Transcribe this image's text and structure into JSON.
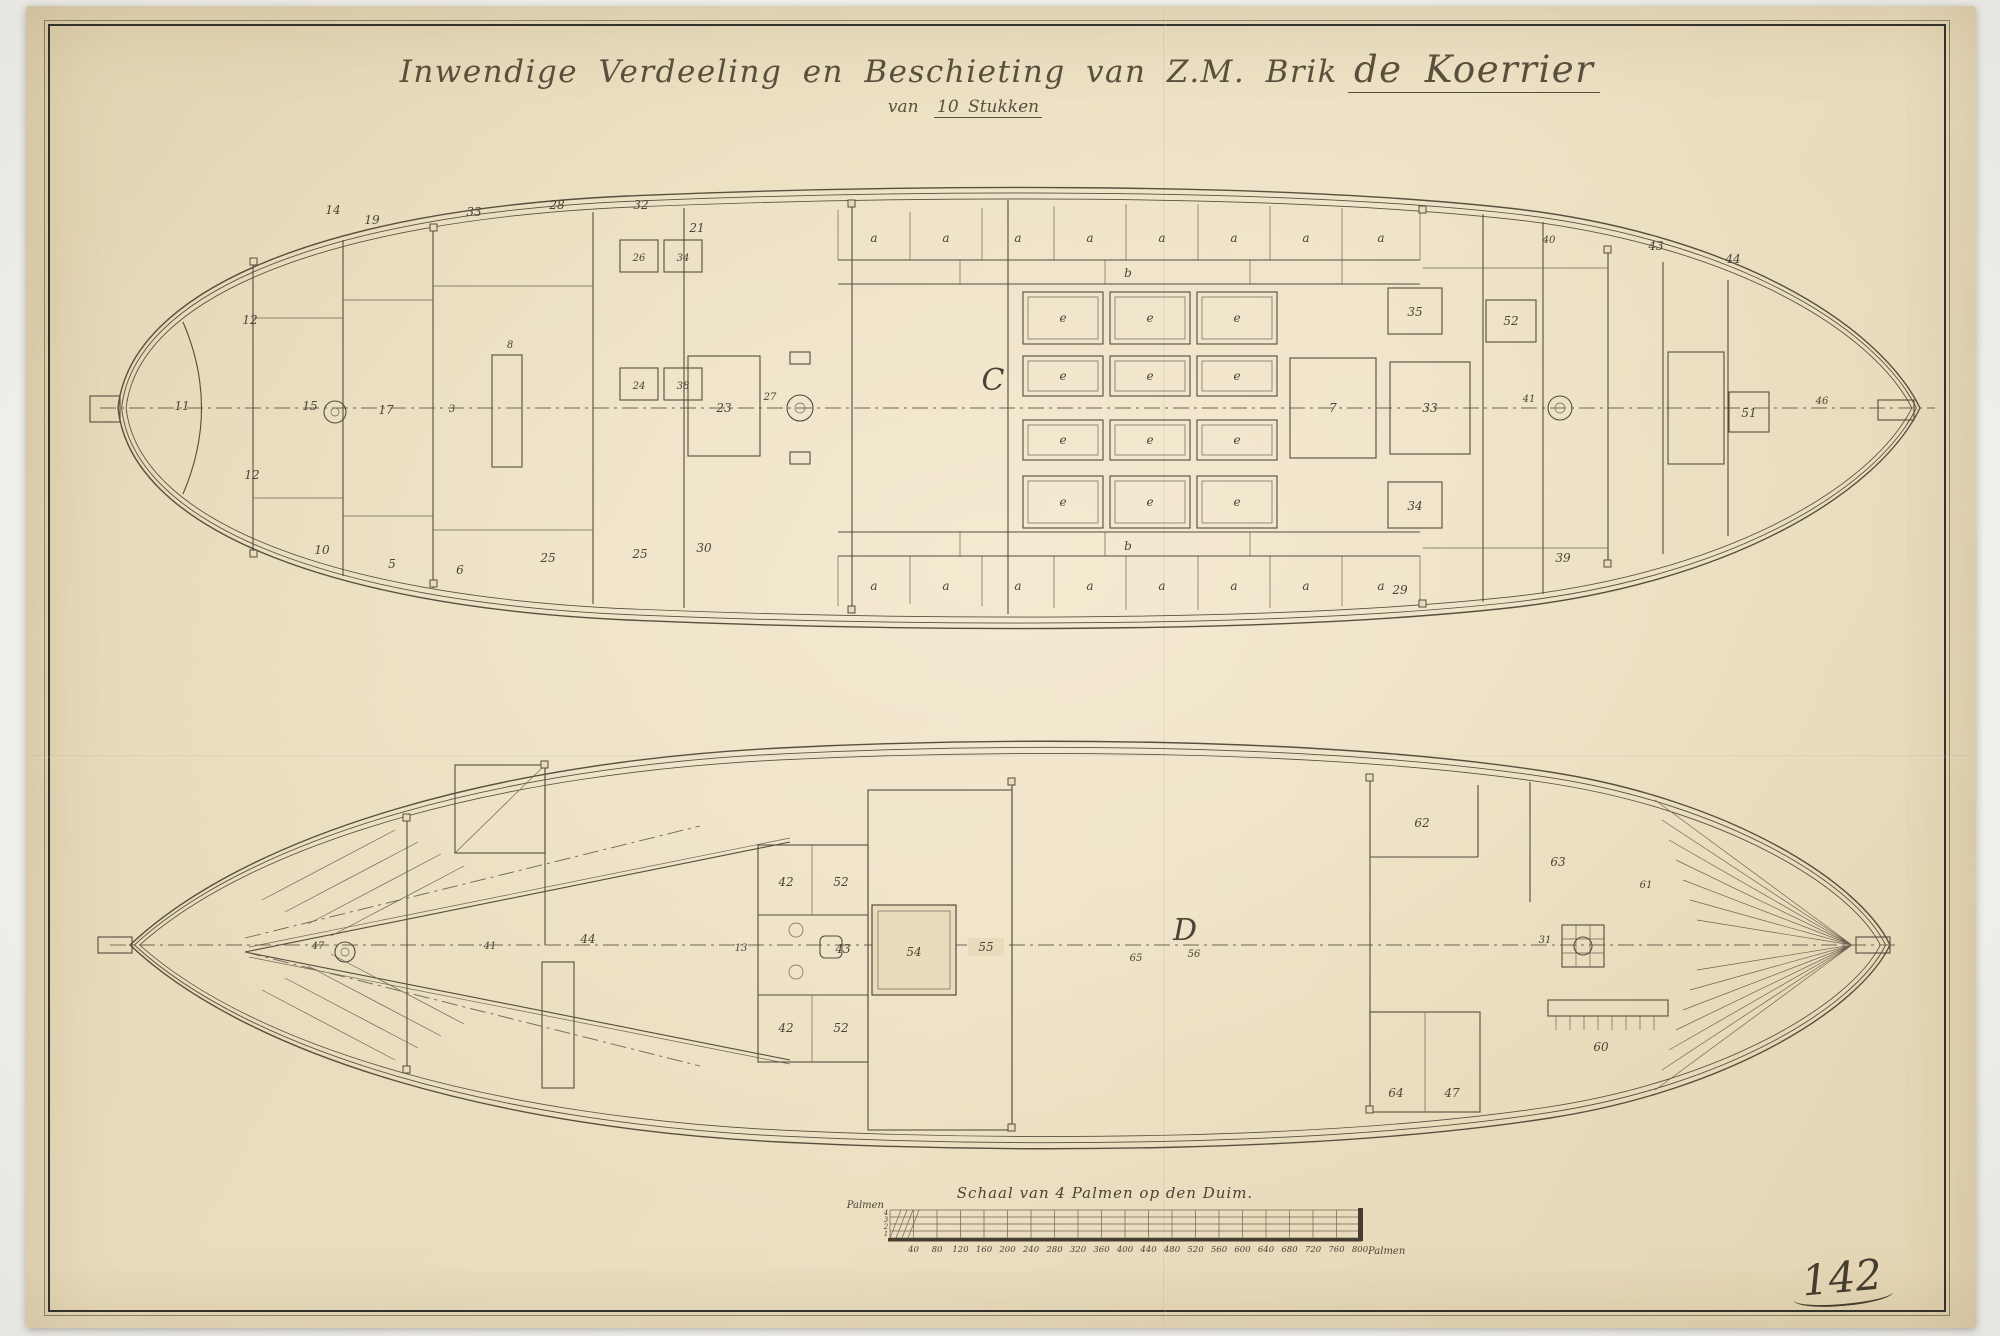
{
  "document": {
    "title_line1": "Inwendige Verdeeling en Beschieting van Z.M. Brik",
    "ship_name": "de Koerrier",
    "subtitle_prefix": "van",
    "subtitle_value": "10 Stukken",
    "sheet_number": "142"
  },
  "colors": {
    "paper": "#e9dcbd",
    "ink": "#4b4336",
    "frame": "#35322a",
    "backdrop": "#f1f0ec"
  },
  "plans": {
    "top": {
      "deck_letter": "C",
      "labels": [
        {
          "t": "a",
          "x": 874,
          "y": 242
        },
        {
          "t": "a",
          "x": 946,
          "y": 242
        },
        {
          "t": "a",
          "x": 1018,
          "y": 242
        },
        {
          "t": "a",
          "x": 1090,
          "y": 242
        },
        {
          "t": "a",
          "x": 1162,
          "y": 242
        },
        {
          "t": "a",
          "x": 1234,
          "y": 242
        },
        {
          "t": "a",
          "x": 1306,
          "y": 242
        },
        {
          "t": "a",
          "x": 1381,
          "y": 242
        },
        {
          "t": "b",
          "x": 1128,
          "y": 277
        },
        {
          "t": "a",
          "x": 874,
          "y": 590
        },
        {
          "t": "a",
          "x": 946,
          "y": 590
        },
        {
          "t": "a",
          "x": 1018,
          "y": 590
        },
        {
          "t": "a",
          "x": 1090,
          "y": 590
        },
        {
          "t": "a",
          "x": 1162,
          "y": 590
        },
        {
          "t": "a",
          "x": 1234,
          "y": 590
        },
        {
          "t": "a",
          "x": 1306,
          "y": 590
        },
        {
          "t": "a",
          "x": 1381,
          "y": 590
        },
        {
          "t": "b",
          "x": 1128,
          "y": 550
        },
        {
          "t": "e",
          "x": 1063,
          "y": 322
        },
        {
          "t": "e",
          "x": 1150,
          "y": 322
        },
        {
          "t": "e",
          "x": 1237,
          "y": 322
        },
        {
          "t": "e",
          "x": 1063,
          "y": 380
        },
        {
          "t": "e",
          "x": 1150,
          "y": 380
        },
        {
          "t": "e",
          "x": 1237,
          "y": 380
        },
        {
          "t": "e",
          "x": 1063,
          "y": 444
        },
        {
          "t": "e",
          "x": 1150,
          "y": 444
        },
        {
          "t": "e",
          "x": 1237,
          "y": 444
        },
        {
          "t": "e",
          "x": 1063,
          "y": 506
        },
        {
          "t": "e",
          "x": 1150,
          "y": 506
        },
        {
          "t": "e",
          "x": 1237,
          "y": 506
        },
        {
          "t": "C",
          "x": 993,
          "y": 390,
          "c": "big"
        },
        {
          "t": "14",
          "x": 333,
          "y": 214
        },
        {
          "t": "19",
          "x": 372,
          "y": 224
        },
        {
          "t": "33",
          "x": 474,
          "y": 216
        },
        {
          "t": "28",
          "x": 557,
          "y": 209
        },
        {
          "t": "32",
          "x": 641,
          "y": 209
        },
        {
          "t": "21",
          "x": 697,
          "y": 232
        },
        {
          "t": "26",
          "x": 639,
          "y": 261,
          "c": "sm"
        },
        {
          "t": "34",
          "x": 683,
          "y": 261,
          "c": "sm"
        },
        {
          "t": "24",
          "x": 639,
          "y": 389,
          "c": "sm"
        },
        {
          "t": "38",
          "x": 683,
          "y": 389,
          "c": "sm"
        },
        {
          "t": "12",
          "x": 250,
          "y": 324
        },
        {
          "t": "11",
          "x": 182,
          "y": 410
        },
        {
          "t": "15",
          "x": 310,
          "y": 410
        },
        {
          "t": "17",
          "x": 386,
          "y": 414
        },
        {
          "t": "12",
          "x": 252,
          "y": 479
        },
        {
          "t": "23",
          "x": 724,
          "y": 412
        },
        {
          "t": "27",
          "x": 770,
          "y": 400,
          "c": "sm"
        },
        {
          "t": "8",
          "x": 510,
          "y": 348,
          "c": "sm"
        },
        {
          "t": "3",
          "x": 452,
          "y": 412,
          "c": "sm"
        },
        {
          "t": "10",
          "x": 322,
          "y": 554
        },
        {
          "t": "5",
          "x": 392,
          "y": 568
        },
        {
          "t": "6",
          "x": 460,
          "y": 574
        },
        {
          "t": "25",
          "x": 548,
          "y": 562
        },
        {
          "t": "25",
          "x": 640,
          "y": 558
        },
        {
          "t": "30",
          "x": 704,
          "y": 552
        },
        {
          "t": "35",
          "x": 1415,
          "y": 316
        },
        {
          "t": "52",
          "x": 1511,
          "y": 325
        },
        {
          "t": "7",
          "x": 1333,
          "y": 412
        },
        {
          "t": "33",
          "x": 1430,
          "y": 412
        },
        {
          "t": "34",
          "x": 1415,
          "y": 510
        },
        {
          "t": "40",
          "x": 1549,
          "y": 243,
          "c": "sm"
        },
        {
          "t": "43",
          "x": 1656,
          "y": 250
        },
        {
          "t": "44",
          "x": 1733,
          "y": 263
        },
        {
          "t": "41",
          "x": 1529,
          "y": 402,
          "c": "sm"
        },
        {
          "t": "51",
          "x": 1749,
          "y": 417
        },
        {
          "t": "46",
          "x": 1822,
          "y": 404,
          "c": "sm"
        },
        {
          "t": "29",
          "x": 1400,
          "y": 594
        },
        {
          "t": "39",
          "x": 1563,
          "y": 562
        }
      ]
    },
    "bottom": {
      "deck_letter": "D",
      "labels": [
        {
          "t": "D",
          "x": 1185,
          "y": 940,
          "c": "big"
        },
        {
          "t": "56",
          "x": 1194,
          "y": 957,
          "c": "sm"
        },
        {
          "t": "65",
          "x": 1136,
          "y": 961,
          "c": "sm"
        },
        {
          "t": "47",
          "x": 318,
          "y": 949,
          "c": "sm"
        },
        {
          "t": "44",
          "x": 588,
          "y": 943
        },
        {
          "t": "41",
          "x": 490,
          "y": 949,
          "c": "sm"
        },
        {
          "t": "42",
          "x": 786,
          "y": 886
        },
        {
          "t": "52",
          "x": 841,
          "y": 886
        },
        {
          "t": "43",
          "x": 843,
          "y": 953
        },
        {
          "t": "42",
          "x": 786,
          "y": 1032
        },
        {
          "t": "52",
          "x": 841,
          "y": 1032
        },
        {
          "t": "13",
          "x": 741,
          "y": 951,
          "c": "sm"
        },
        {
          "t": "54",
          "x": 914,
          "y": 956
        },
        {
          "t": "55",
          "x": 986,
          "y": 951
        },
        {
          "t": "62",
          "x": 1422,
          "y": 827
        },
        {
          "t": "63",
          "x": 1558,
          "y": 866
        },
        {
          "t": "61",
          "x": 1646,
          "y": 888,
          "c": "sm"
        },
        {
          "t": "31",
          "x": 1545,
          "y": 943,
          "c": "sm"
        },
        {
          "t": "60",
          "x": 1601,
          "y": 1051
        },
        {
          "t": "64",
          "x": 1396,
          "y": 1097
        },
        {
          "t": "47",
          "x": 1452,
          "y": 1097
        }
      ]
    }
  },
  "scale_bar": {
    "label": "Schaal van 4 Palmen op den Duim.",
    "unit_left": "Palmen",
    "unit_right": "Palmen",
    "sub_digits": [
      {
        "t": "4",
        "x": 886,
        "y": 1215,
        "c": "xs"
      },
      {
        "t": "3",
        "x": 886,
        "y": 1222,
        "c": "xs"
      },
      {
        "t": "2",
        "x": 886,
        "y": 1229,
        "c": "xs"
      },
      {
        "t": "1",
        "x": 886,
        "y": 1236,
        "c": "xs"
      }
    ],
    "ticks": [
      "40",
      "80",
      "120",
      "160",
      "200",
      "240",
      "280",
      "320",
      "360",
      "400",
      "440",
      "480",
      "520",
      "560",
      "600",
      "640",
      "680",
      "720",
      "760",
      "800"
    ]
  }
}
